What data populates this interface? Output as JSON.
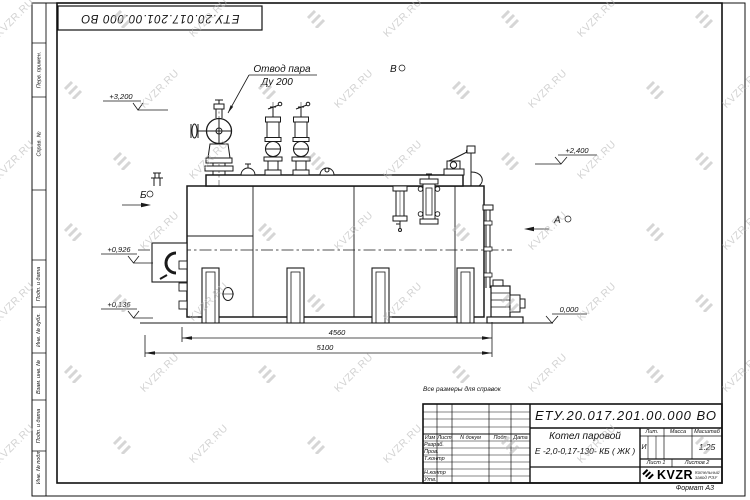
{
  "sheet": {
    "doc_number": "ЕТУ.20.017.201.00.000  ВО",
    "note": "Все размеры для справок",
    "format_label": "Формат А3"
  },
  "title_block": {
    "doc_number": "ЕТУ.20.017.201.00.000  ВО",
    "name_line1": "Котел паровой",
    "name_line2": "Е -2,0-0,17-130- КБ ( ЖК )",
    "col_izm": "Изм",
    "col_list": "Лист",
    "col_ndokum": "N докум",
    "col_podp": "Подп",
    "col_data": "Дата",
    "row_razrab": "Разраб.",
    "row_prov": "Пров.",
    "row_tkontr": "Т.контр",
    "row_nkontr": "Н.контр",
    "row_utv": "Утв.",
    "lit_label": "Лит.",
    "mass_label": "Масса",
    "scale_label": "Масштаб",
    "lit_value": "И",
    "scale_value": "1:25",
    "sheet_label": "Лист 1",
    "sheets_label": "Листов 2",
    "logo_text": "KVZR",
    "logo_sub1": "Котельный",
    "logo_sub2": "завод РЭУ"
  },
  "margin_labels": {
    "perv": "Перв. примен.",
    "sprav": "Справ. №",
    "podp1": "Подп. и дата",
    "inv_dubl": "Инв. № дубл.",
    "vzam": "Взам. инв. №",
    "podp2": "Подп. и дата",
    "inv_podl": "Инв. № подл."
  },
  "drawing": {
    "callout_line1": "Отвод пара",
    "callout_line2": "Ду 200",
    "view_a": "А",
    "view_b": "Б",
    "view_v": "В",
    "elev_3200": "+3,200",
    "elev_2400": "+2,400",
    "elev_0926": "+0,926",
    "elev_0136": "+0,136",
    "elev_0000": "0,000",
    "dim_4560": "4560",
    "dim_5100": "5100"
  },
  "watermark": {
    "text": "KVZR.RU",
    "color": "#b5b5b5"
  }
}
